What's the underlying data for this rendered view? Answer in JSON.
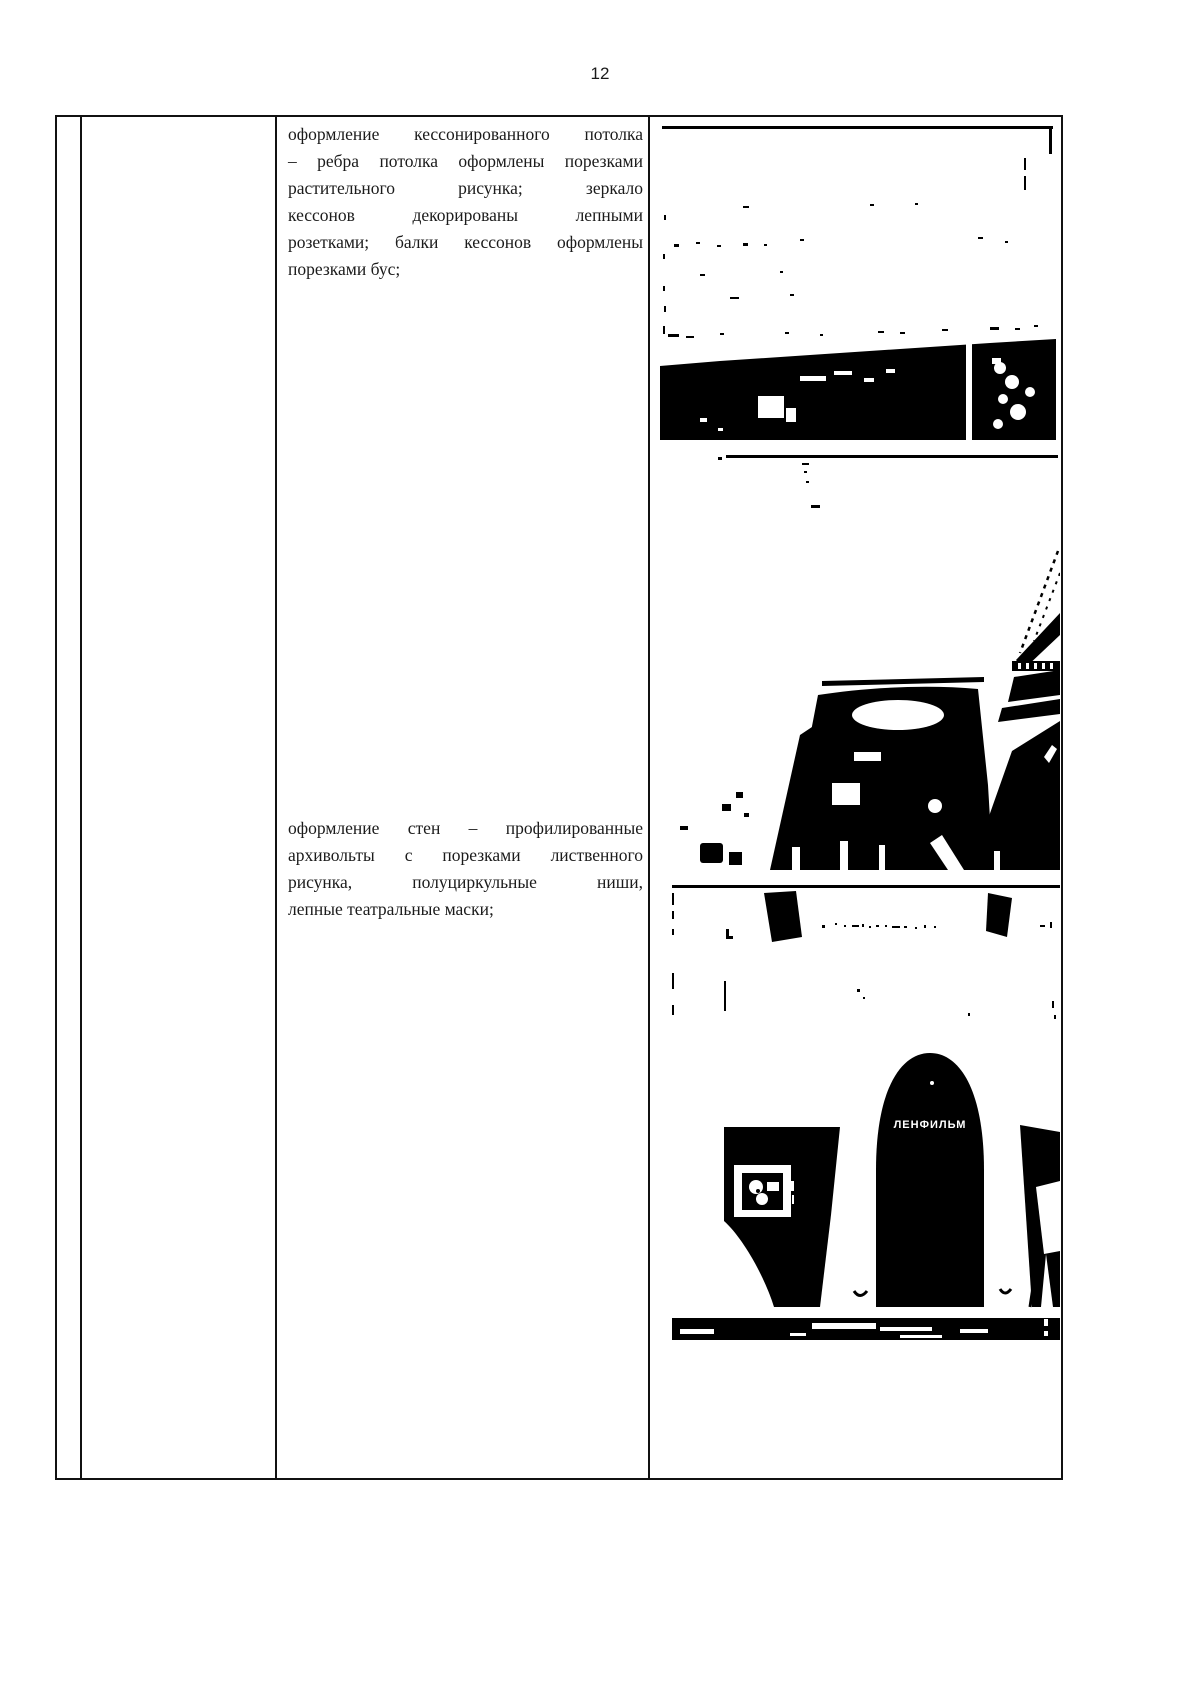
{
  "page": {
    "number": "12"
  },
  "table": {
    "text_cell": {
      "paragraphs": [
        {
          "lines": [
            "оформление кессонированного потолка",
            "– ребра потолка оформлены порезками",
            "растительного рисунка; зеркало",
            "кессонов декорированы лепными",
            "розетками; балки кессонов оформлены",
            "порезками бус;"
          ]
        },
        {
          "lines": [
            "оформление стен – профилированные",
            "архивольты с порезками лиственного",
            "рисунка, полуциркульные ниши,",
            "лепные театральные маски;"
          ]
        }
      ]
    },
    "photo_cell": {
      "photos": [
        {
          "name": "coffered-ceiling-photo"
        },
        {
          "name": "interior-staircase-photo"
        },
        {
          "name": "lenfilm-arch-photo",
          "sign_text": "ЛЕНФИЛЬМ"
        }
      ]
    }
  },
  "colors": {
    "ink": "#1a1a1a",
    "border": "#111111",
    "paper": "#ffffff"
  }
}
